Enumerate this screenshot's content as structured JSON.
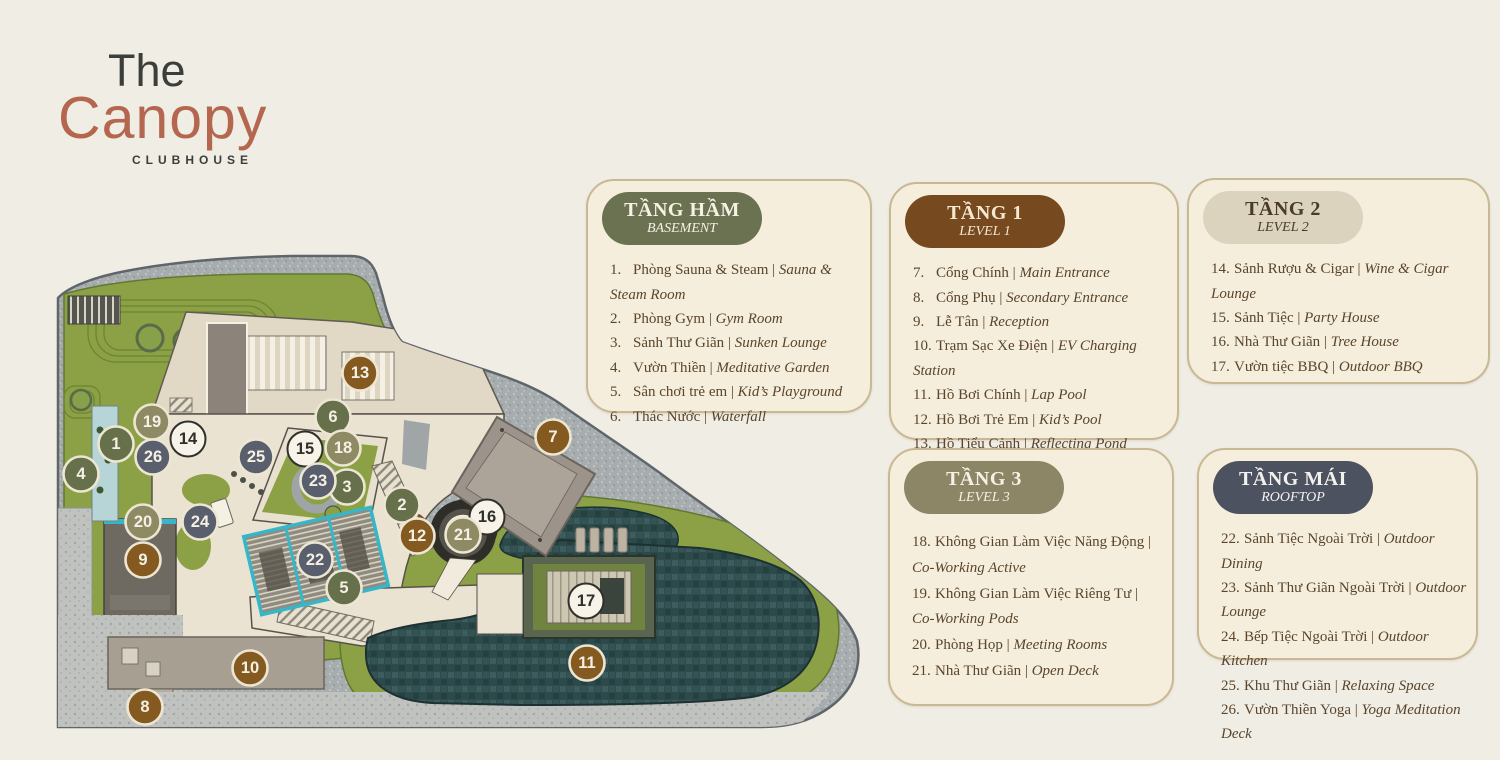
{
  "logo": {
    "line1": "The",
    "line2": "Canopy",
    "line3": "CLUBHOUSE"
  },
  "legend": {
    "cards": [
      {
        "id": "basement",
        "title": "TẦNG HẦM",
        "subtitle": "BASEMENT",
        "pill_bg": "#6B7252",
        "pill_fg": "#F6F1E2",
        "items": [
          {
            "num": "1",
            "vi": "Phòng Sauna & Steam",
            "en": "Sauna & Steam Room"
          },
          {
            "num": "2",
            "vi": "Phòng Gym",
            "en": "Gym Room"
          },
          {
            "num": "3",
            "vi": "Sảnh Thư Giãn",
            "en": "Sunken Lounge"
          },
          {
            "num": "4",
            "vi": "Vườn Thiền",
            "en": "Meditative Garden"
          },
          {
            "num": "5",
            "vi": "Sân chơi trẻ em",
            "en": "Kid’s Playground"
          },
          {
            "num": "6",
            "vi": "Thác Nước",
            "en": "Waterfall"
          }
        ]
      },
      {
        "id": "level1",
        "title": "TẦNG 1",
        "subtitle": "LEVEL 1",
        "pill_bg": "#76491F",
        "pill_fg": "#F6E9D2",
        "items": [
          {
            "num": "7",
            "vi": "Cổng Chính",
            "en": "Main Entrance"
          },
          {
            "num": "8",
            "vi": "Cổng Phụ",
            "en": "Secondary Entrance"
          },
          {
            "num": "9",
            "vi": "Lễ Tân",
            "en": "Reception"
          },
          {
            "num": "10",
            "vi": "Trạm Sạc Xe Điện",
            "en": "EV Charging Station"
          },
          {
            "num": "11",
            "vi": "Hồ Bơi Chính",
            "en": "Lap Pool"
          },
          {
            "num": "12",
            "vi": "Hồ Bơi Trẻ Em",
            "en": "Kid’s Pool"
          },
          {
            "num": "13",
            "vi": "Hồ Tiểu Cảnh",
            "en": "Reflecting Pond"
          }
        ]
      },
      {
        "id": "level2",
        "title": "TẦNG 2",
        "subtitle": "LEVEL 2",
        "pill_bg": "#DCD3BF",
        "pill_fg": "#4A3B26",
        "items": [
          {
            "num": "14",
            "vi": "Sảnh Rượu & Cigar",
            "en": "Wine & Cigar Lounge"
          },
          {
            "num": "15",
            "vi": "Sảnh Tiệc",
            "en": "Party House"
          },
          {
            "num": "16",
            "vi": "Nhà Thư Giãn",
            "en": "Tree House"
          },
          {
            "num": "17",
            "vi": "Vườn tiệc BBQ",
            "en": "Outdoor BBQ"
          }
        ]
      },
      {
        "id": "level3",
        "title": "TẦNG 3",
        "subtitle": "LEVEL 3",
        "pill_bg": "#8C8667",
        "pill_fg": "#F6F1E2",
        "items": [
          {
            "num": "18",
            "vi": "Không Gian Làm Việc Năng Động",
            "en": "Co-Working Active"
          },
          {
            "num": "19",
            "vi": "Không Gian Làm Việc Riêng Tư",
            "en": "Co-Working Pods"
          },
          {
            "num": "20",
            "vi": "Phòng Họp",
            "en": "Meeting Rooms"
          },
          {
            "num": "21",
            "vi": "Nhà Thư Giãn",
            "en": "Open Deck"
          }
        ]
      },
      {
        "id": "rooftop",
        "title": "TẦNG MÁI",
        "subtitle": "ROOFTOP",
        "pill_bg": "#4D5260",
        "pill_fg": "#F2F1EC",
        "items": [
          {
            "num": "22",
            "vi": "Sảnh Tiệc Ngoài Trời",
            "en": "Outdoor Dining"
          },
          {
            "num": "23",
            "vi": "Sảnh Thư Giãn Ngoài Trời",
            "en": "Outdoor Lounge"
          },
          {
            "num": "24",
            "vi": "Bếp Tiệc Ngoài Trời",
            "en": "Outdoor Kitchen"
          },
          {
            "num": "25",
            "vi": "Khu Thư Giãn",
            "en": "Relaxing Space"
          },
          {
            "num": "26",
            "vi": "Vườn Thiền Yoga",
            "en": "Yoga Meditation Deck"
          }
        ]
      }
    ]
  },
  "map": {
    "floor_colors": {
      "basement": {
        "fill": "#66704B",
        "text": "#F4F0E3",
        "ring": "#EDE6D3"
      },
      "level1": {
        "fill": "#855A21",
        "text": "#F4F0E3",
        "ring": "#EDE6D3"
      },
      "level2": {
        "fill": "#F7F3E8",
        "text": "#2F2F2B",
        "ring": "#2F2F2B"
      },
      "level3": {
        "fill": "#8E8A64",
        "text": "#F4F0E3",
        "ring": "#EDE6D3"
      },
      "rooftop": {
        "fill": "#5A5F6E",
        "text": "#F4F0E3",
        "ring": "#EDE6D3"
      }
    },
    "markers": [
      {
        "n": 1,
        "x": 116,
        "y": 444,
        "floor": "basement"
      },
      {
        "n": 2,
        "x": 402,
        "y": 505,
        "floor": "basement"
      },
      {
        "n": 3,
        "x": 347,
        "y": 487,
        "floor": "basement"
      },
      {
        "n": 4,
        "x": 81,
        "y": 474,
        "floor": "basement"
      },
      {
        "n": 5,
        "x": 344,
        "y": 588,
        "floor": "basement"
      },
      {
        "n": 6,
        "x": 333,
        "y": 417,
        "floor": "basement"
      },
      {
        "n": 7,
        "x": 553,
        "y": 437,
        "floor": "level1"
      },
      {
        "n": 8,
        "x": 145,
        "y": 707,
        "floor": "level1"
      },
      {
        "n": 9,
        "x": 143,
        "y": 560,
        "floor": "level1"
      },
      {
        "n": 10,
        "x": 250,
        "y": 668,
        "floor": "level1"
      },
      {
        "n": 11,
        "x": 587,
        "y": 663,
        "floor": "level1"
      },
      {
        "n": 12,
        "x": 417,
        "y": 536,
        "floor": "level1"
      },
      {
        "n": 13,
        "x": 360,
        "y": 373,
        "floor": "level1"
      },
      {
        "n": 14,
        "x": 188,
        "y": 439,
        "floor": "level2"
      },
      {
        "n": 15,
        "x": 305,
        "y": 449,
        "floor": "level2"
      },
      {
        "n": 16,
        "x": 487,
        "y": 517,
        "floor": "level2"
      },
      {
        "n": 17,
        "x": 586,
        "y": 601,
        "floor": "level2"
      },
      {
        "n": 18,
        "x": 343,
        "y": 448,
        "floor": "level3"
      },
      {
        "n": 19,
        "x": 152,
        "y": 422,
        "floor": "level3"
      },
      {
        "n": 20,
        "x": 143,
        "y": 522,
        "floor": "level3"
      },
      {
        "n": 21,
        "x": 463,
        "y": 535,
        "floor": "level3"
      },
      {
        "n": 22,
        "x": 315,
        "y": 560,
        "floor": "rooftop"
      },
      {
        "n": 23,
        "x": 318,
        "y": 481,
        "floor": "rooftop"
      },
      {
        "n": 24,
        "x": 200,
        "y": 522,
        "floor": "rooftop"
      },
      {
        "n": 25,
        "x": 256,
        "y": 457,
        "floor": "rooftop"
      },
      {
        "n": 26,
        "x": 153,
        "y": 457,
        "floor": "rooftop"
      }
    ]
  }
}
